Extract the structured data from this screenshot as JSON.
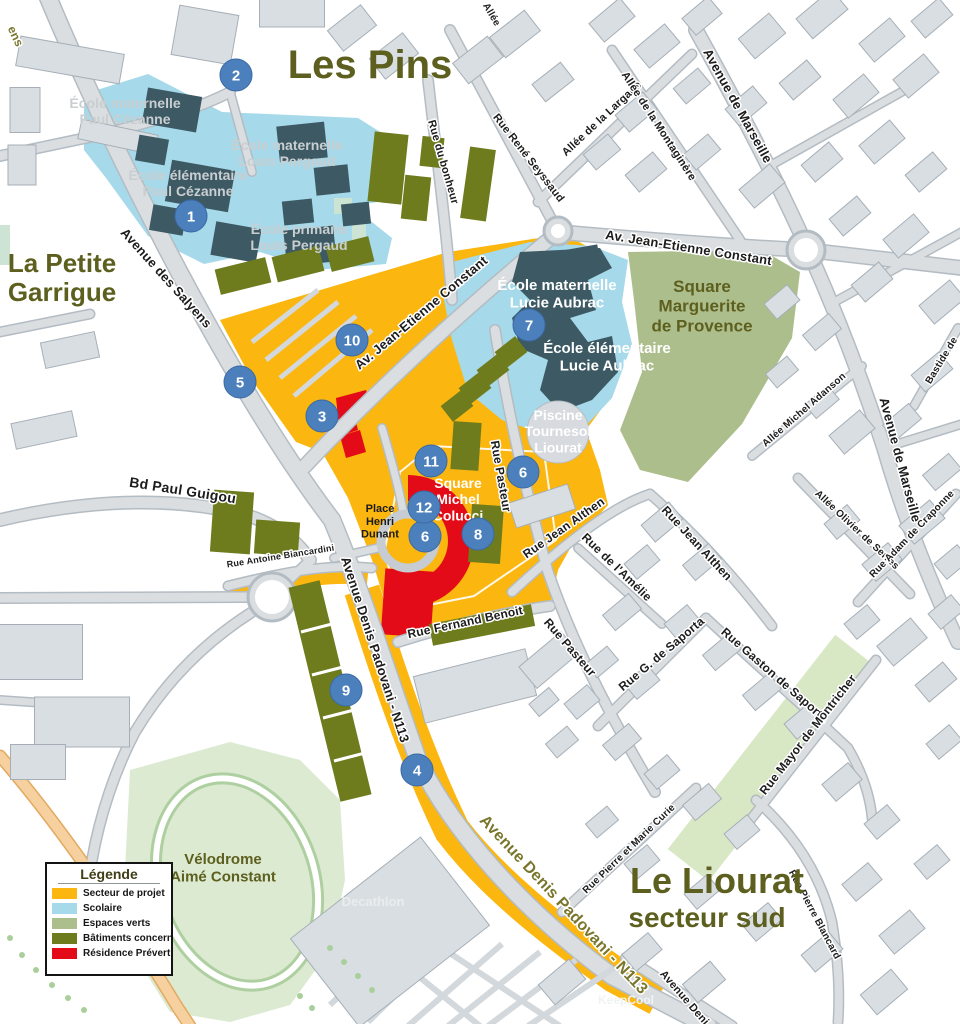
{
  "legend": {
    "title": "Légende",
    "items": [
      {
        "label": "Secteur de projet",
        "color": "#FBB60F"
      },
      {
        "label": "Scolaire",
        "color": "#A6D9E9"
      },
      {
        "label": "Espaces verts",
        "color": "#ADBE8D"
      },
      {
        "label": "Bâtiments concernés",
        "color": "#6E7C1E"
      },
      {
        "label": "Résidence Prévert à dém",
        "color": "#E30B17"
      }
    ]
  },
  "districts": [
    {
      "lines": [
        "Les Pins"
      ],
      "x": 370,
      "y": 78,
      "size": 40
    },
    {
      "lines": [
        "La Petite",
        "Garrigue"
      ],
      "x": 62,
      "y": 272,
      "size": 26
    },
    {
      "lines": [
        "Le Liourat"
      ],
      "x": 717,
      "y": 893,
      "size": 36
    },
    {
      "lines": [
        "secteur sud"
      ],
      "x": 707,
      "y": 927,
      "size": 28
    }
  ],
  "places": [
    {
      "lines": [
        "École maternelle",
        "Paul Cézanne"
      ],
      "x": 125,
      "y": 108,
      "size": 14,
      "color": "#c9ced1"
    },
    {
      "lines": [
        "École élémentaire",
        "Paul Cézanne"
      ],
      "x": 188,
      "y": 180,
      "size": 14,
      "color": "#c9ced1"
    },
    {
      "lines": [
        "École maternelle",
        "Louis Pergaud"
      ],
      "x": 287,
      "y": 150,
      "size": 14,
      "color": "#c9ced1"
    },
    {
      "lines": [
        "École primaire",
        "Louis Pergaud"
      ],
      "x": 299,
      "y": 234,
      "size": 14,
      "color": "#c9ced1"
    },
    {
      "lines": [
        "École maternelle",
        "Lucie Aubrac"
      ],
      "x": 557,
      "y": 290,
      "size": 15,
      "color": "#ffffff"
    },
    {
      "lines": [
        "École élémentaire",
        "Lucie Aubrac"
      ],
      "x": 607,
      "y": 353,
      "size": 15,
      "color": "#ffffff"
    },
    {
      "lines": [
        "Piscine",
        "Tournesol",
        "Liourat"
      ],
      "x": 558,
      "y": 420,
      "size": 14,
      "color": "#ffffff"
    },
    {
      "lines": [
        "Square",
        "Michel",
        "Colucci"
      ],
      "x": 458,
      "y": 488,
      "size": 14,
      "color": "#ffffff"
    },
    {
      "lines": [
        "Place",
        "Henri",
        "Dunant"
      ],
      "x": 380,
      "y": 512,
      "size": 11,
      "color": "#1a1a1a"
    },
    {
      "lines": [
        "Square",
        "Marguerite",
        "de Provence"
      ],
      "x": 702,
      "y": 292,
      "size": 17,
      "color": "#5d5f1e",
      "bold": true
    },
    {
      "lines": [
        "Vélodrome",
        "Aimé Constant"
      ],
      "x": 223,
      "y": 864,
      "size": 15,
      "color": "#5d5f1e",
      "bold": true
    },
    {
      "lines": [
        "Decathlon"
      ],
      "x": 373,
      "y": 906,
      "size": 13,
      "color": "#e9edef"
    },
    {
      "lines": [
        "KeepCool"
      ],
      "x": 626,
      "y": 1004,
      "size": 12,
      "color": "#f0f3f4"
    }
  ],
  "streets": [
    {
      "text": "Avenue des Salyens",
      "x": 163,
      "y": 281,
      "rot": 48,
      "size": 13
    },
    {
      "text": "ens",
      "x": 12,
      "y": 38,
      "rot": 65,
      "size": 12,
      "gold": true
    },
    {
      "text": "Av. Jean-Etienne Constant",
      "x": 424,
      "y": 316,
      "rot": -40,
      "size": 13
    },
    {
      "text": "Av. Jean-Etienne Constant",
      "x": 688,
      "y": 252,
      "rot": 9,
      "size": 13
    },
    {
      "text": "Rue du bonheur",
      "x": 440,
      "y": 163,
      "rot": 74,
      "size": 11
    },
    {
      "text": "Rue René Seyssaud",
      "x": 526,
      "y": 160,
      "rot": 52,
      "size": 11
    },
    {
      "text": "Allée de la Largade",
      "x": 604,
      "y": 121,
      "rot": -43,
      "size": 11
    },
    {
      "text": "Allée de la Montaginère",
      "x": 656,
      "y": 128,
      "rot": 57,
      "size": 11
    },
    {
      "text": "Allée",
      "x": 489,
      "y": 16,
      "rot": 60,
      "size": 10
    },
    {
      "text": "Avenue de Marseille",
      "x": 734,
      "y": 108,
      "rot": 61,
      "size": 13
    },
    {
      "text": "Avenue de Marseille",
      "x": 896,
      "y": 461,
      "rot": 75,
      "size": 13
    },
    {
      "text": "Bastide de",
      "x": 944,
      "y": 362,
      "rot": -59,
      "size": 10
    },
    {
      "text": "Allée Michel Adanson",
      "x": 806,
      "y": 412,
      "rot": -41,
      "size": 10
    },
    {
      "text": "Allée Olivier de Serres",
      "x": 855,
      "y": 532,
      "rot": 43,
      "size": 10
    },
    {
      "text": "Rue Adam de Craponne",
      "x": 914,
      "y": 536,
      "rot": -46,
      "size": 10
    },
    {
      "text": "Bd Paul Guigou",
      "x": 182,
      "y": 495,
      "rot": 9,
      "size": 14
    },
    {
      "text": "Rue Antoine Biancardini",
      "x": 281,
      "y": 559,
      "rot": -9,
      "size": 9
    },
    {
      "text": "Rue Fernand Benoit",
      "x": 466,
      "y": 626,
      "rot": -12,
      "size": 12
    },
    {
      "text": "Rue Pasteur",
      "x": 497,
      "y": 477,
      "rot": 80,
      "size": 12
    },
    {
      "text": "Rue Pasteur",
      "x": 567,
      "y": 650,
      "rot": 49,
      "size": 12
    },
    {
      "text": "Rue Jean Althen",
      "x": 566,
      "y": 531,
      "rot": -35,
      "size": 12
    },
    {
      "text": "Rue Jean Althen",
      "x": 694,
      "y": 546,
      "rot": 47,
      "size": 12
    },
    {
      "text": "Rue de l'Amélie",
      "x": 614,
      "y": 570,
      "rot": 44,
      "size": 12
    },
    {
      "text": "Rue G. de Saporta",
      "x": 664,
      "y": 657,
      "rot": -40,
      "size": 12
    },
    {
      "text": "Rue Gaston de Saporta",
      "x": 772,
      "y": 678,
      "rot": 41,
      "size": 12
    },
    {
      "text": "Rue Mayor de Montricher",
      "x": 811,
      "y": 737,
      "rot": -52,
      "size": 12
    },
    {
      "text": "Rue Pierre et Marie Curie",
      "x": 631,
      "y": 851,
      "rot": -44,
      "size": 10
    },
    {
      "text": "Rue Pierre Blancard",
      "x": 812,
      "y": 916,
      "rot": 62,
      "size": 10
    },
    {
      "text": "Avenue Denis Padovani - N113",
      "x": 371,
      "y": 651,
      "rot": 72,
      "size": 13
    },
    {
      "text": "Avenue Denis Padovani - N113",
      "x": 560,
      "y": 908,
      "rot": 47,
      "size": 16,
      "gold": true
    },
    {
      "text": "Avenue Deni",
      "x": 682,
      "y": 1000,
      "rot": 49,
      "size": 11
    }
  ],
  "markers": [
    {
      "n": "1",
      "x": 191,
      "y": 216
    },
    {
      "n": "2",
      "x": 236,
      "y": 75
    },
    {
      "n": "3",
      "x": 322,
      "y": 416
    },
    {
      "n": "4",
      "x": 417,
      "y": 770
    },
    {
      "n": "5",
      "x": 240,
      "y": 382
    },
    {
      "n": "6",
      "x": 523,
      "y": 472
    },
    {
      "n": "6",
      "x": 425,
      "y": 536
    },
    {
      "n": "7",
      "x": 529,
      "y": 325
    },
    {
      "n": "8",
      "x": 478,
      "y": 534
    },
    {
      "n": "9",
      "x": 346,
      "y": 690
    },
    {
      "n": "10",
      "x": 352,
      "y": 340
    },
    {
      "n": "11",
      "x": 431,
      "y": 461
    },
    {
      "n": "12",
      "x": 424,
      "y": 507
    }
  ],
  "colors": {
    "project": "#FBB60F",
    "school_zone": "#A6D9E9",
    "green_space": "#ADBE8D",
    "concerned_buildings": "#6E7C1E",
    "residence_red": "#E30B17",
    "marker_blue": "#4C80BD",
    "district_title": "#5D5F1E"
  }
}
